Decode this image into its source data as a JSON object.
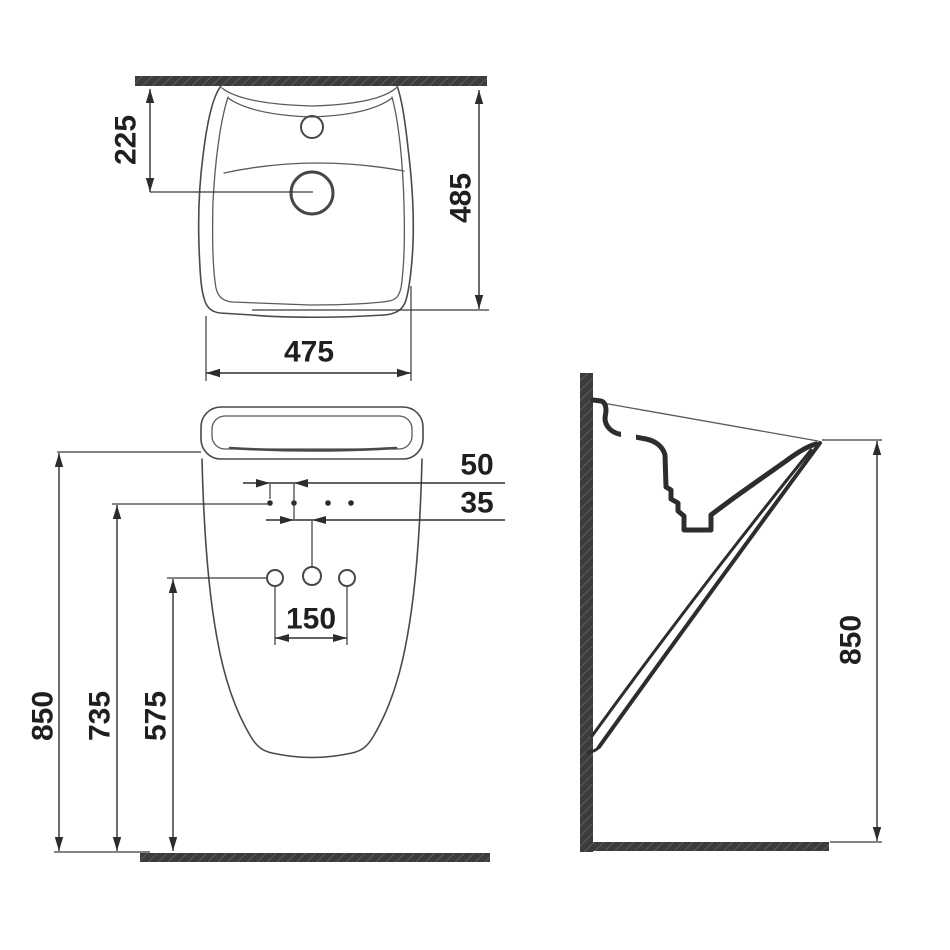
{
  "views": {
    "top": {
      "label_drain_setback": "225",
      "label_depth": "485",
      "label_width": "475"
    },
    "front": {
      "label_height": "850",
      "label_fixing_height": "735",
      "label_outlet_height": "575",
      "label_hole_spacing": "150",
      "label_offset_upper": "50",
      "label_offset_lower": "35"
    },
    "side": {
      "label_height": "850"
    }
  },
  "colors": {
    "line": "#4a4a4a",
    "dimension": "#2f2f2f",
    "wall_fill": "#3c3c3c",
    "wall_hatch": "#5c5c5c",
    "background": "#ffffff",
    "text": "#1f1f1f"
  }
}
